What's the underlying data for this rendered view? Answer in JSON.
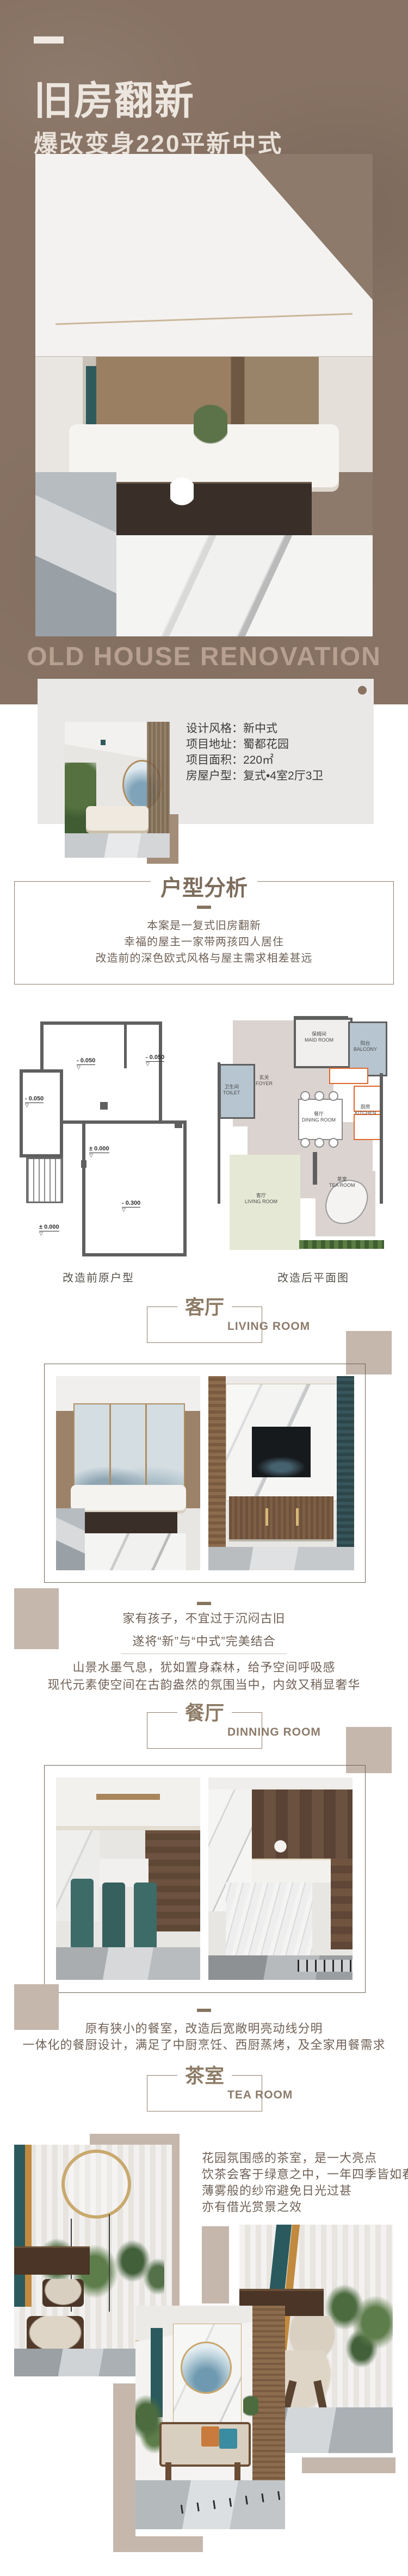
{
  "header": {
    "title": "旧房翻新",
    "subtitle": "爆改变身220平新中式",
    "watermark": "OLD HOUSE RENOVATION"
  },
  "info_card": {
    "rows": [
      {
        "label": "设计风格：",
        "value": "新中式"
      },
      {
        "label": "项目地址：",
        "value": "蜀都花园"
      },
      {
        "label": "项目面积：",
        "value": "220㎡"
      },
      {
        "label": "房屋户型：",
        "value": "复式•4室2厅3卫"
      }
    ]
  },
  "analysis": {
    "title": "户型分析",
    "lines": [
      "本案是一复式旧房翻新",
      "幸福的屋主一家带两孩四人居住",
      "改造前的深色欧式风格与屋主需求相差甚远"
    ]
  },
  "floorplans": {
    "before_caption": "改造前原户型",
    "after_caption": "改造后平面图",
    "level_marker": "▽",
    "before_levels": [
      "- 0.050",
      "- 0.050",
      "- 0.050",
      "± 0.000",
      "- 0.300",
      "± 0.000"
    ],
    "after_rooms": [
      {
        "zh": "玄关",
        "en": "FOYER"
      },
      {
        "zh": "保姆间",
        "en": "MAID ROOM"
      },
      {
        "zh": "阳台",
        "en": "BALCONY"
      },
      {
        "zh": "卫生间",
        "en": "TOILET"
      },
      {
        "zh": "餐厅",
        "en": "DINING ROOM"
      },
      {
        "zh": "厨房",
        "en": "KITCHEN"
      },
      {
        "zh": "客厅",
        "en": "LIVING ROOM"
      },
      {
        "zh": "茶室",
        "en": "TEA ROOM"
      }
    ]
  },
  "sections": {
    "living": {
      "zh": "客厅",
      "en": "LIVING ROOM",
      "para1": [
        "家有孩子，不宜过于沉闷古旧",
        "遂将“新”与“中式”完美结合"
      ],
      "para2": [
        "山景水墨气息，犹如置身森林，给予空间呼吸感",
        "现代元素使空间在古韵盎然的氛围当中，内敛又稍显奢华"
      ]
    },
    "dining": {
      "zh": "餐厅",
      "en": "DINNING ROOM",
      "para": [
        "原有狭小的餐室，改造后宽敞明亮动线分明",
        "一体化的餐厨设计，满足了中厨烹饪、西厨蒸烤，及全家用餐需求"
      ]
    },
    "tea": {
      "zh": "茶室",
      "en": "TEA ROOM",
      "para": [
        "花园氛围感的茶室，是一大亮点",
        "饮茶会客于绿意之中，一年四季皆如春",
        "薄雾般的纱帘避免日光过甚",
        "亦有借光赏景之效"
      ]
    }
  },
  "colors": {
    "header_bg": "#877263",
    "title_text": "#ece6df",
    "watermark_text": "#b7a08f",
    "card_bg": "#e9e8e6",
    "accent_brown": "#8a7260",
    "tan_block": "#c5b7ac",
    "heading_brown": "#8d7b66",
    "body_text": "#6f6156",
    "kitchen_outline": "#e0662a"
  }
}
